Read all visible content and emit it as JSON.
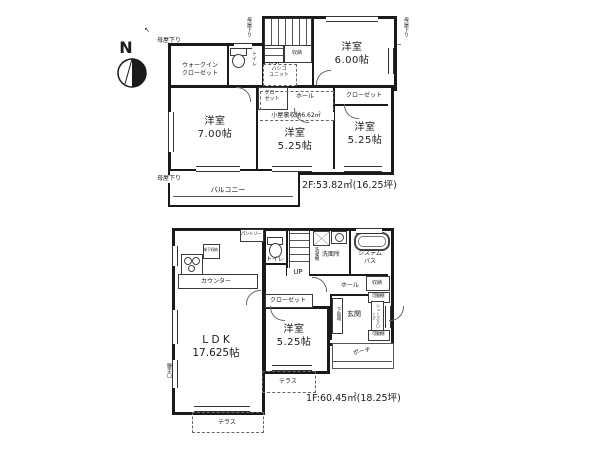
{
  "compass": {
    "label": "N"
  },
  "icons": {
    "arrow_nw": "↖",
    "arrow_down": "↓"
  },
  "floor2": {
    "eaves_top_left": "母屋下り",
    "eaves_top_mid": "母屋下り",
    "eaves_top_right": "母屋下り",
    "eaves_left": "母屋下り",
    "walk_in_closet": "ウォークイン\nクローゼット",
    "toilet": "トイレ",
    "stairs_down": "D.N",
    "storage": "収納",
    "ladder_unit": "ハシゴ\nユニット",
    "closet_small": "クロー\nゼット",
    "hall": "ホール",
    "closet_right": "クローゼット",
    "attic_storage": "小屋裏収納6.62㎡",
    "room_ne": "洋室\n6.00帖",
    "room_w": "洋室\n7.00帖",
    "room_c": "洋室\n5.25帖",
    "room_e": "洋室\n5.25帖",
    "balcony": "バルコニー",
    "area_caption": "2F:53.82㎡(16.25坪)"
  },
  "floor1": {
    "pantry": "パントリー",
    "underfloor_storage": "床下収納",
    "counter": "カウンター",
    "toilet": "トイレ",
    "stairs_up": "UP",
    "washer": "洗濯機",
    "washroom": "洗面所",
    "system_bath": "システム\nバス",
    "storage": "収納",
    "hall": "ホール",
    "closet": "クローゼット",
    "shoe_cabinet": "下駄箱",
    "entrance": "玄関",
    "movable_shelf_top": "可動棚",
    "shoe_cloak": "シューズクローク",
    "movable_shelf_bottom": "可動棚",
    "porch": "ポーチ",
    "room": "洋室\n5.25帖",
    "ldk": "L D K\n17.625帖",
    "terrace_mid": "テラス",
    "terrace_bottom": "テラス",
    "back_door": "勝手口",
    "area_caption": "1F:60.45㎡(18.25坪)"
  }
}
